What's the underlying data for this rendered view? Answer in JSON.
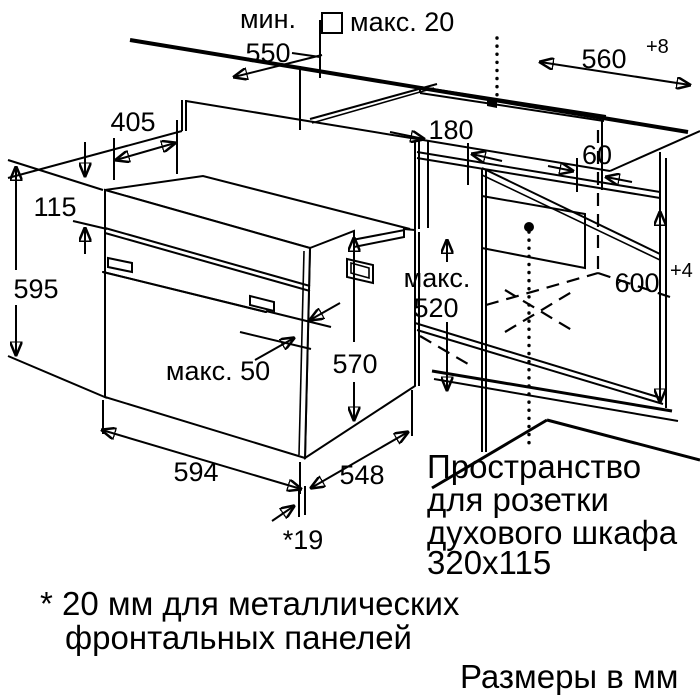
{
  "labels": {
    "min_line1": "мин.",
    "min_line2": "550",
    "max20": "макс. 20",
    "d560": "560",
    "d560_sup": "+8",
    "d405": "405",
    "d115": "115",
    "d595": "595",
    "d180": "180",
    "d60": "60",
    "max520_line1": "макс.",
    "max520_line2": "520",
    "d600": "600",
    "d600_sup": "+4",
    "d570": "570",
    "max50": "макс. 50",
    "d594": "594",
    "d548": "548",
    "d19": "*19",
    "socket_line1": "Пространство",
    "socket_line2": "для розетки",
    "socket_line3": "духового шкафа",
    "socket_line4": "320x115",
    "footnote_line1": "* 20 мм для металлических",
    "footnote_line2": "фронтальных панелей",
    "units": "Размеры в мм"
  },
  "colors": {
    "ink": "#000000",
    "background": "#ffffff"
  }
}
